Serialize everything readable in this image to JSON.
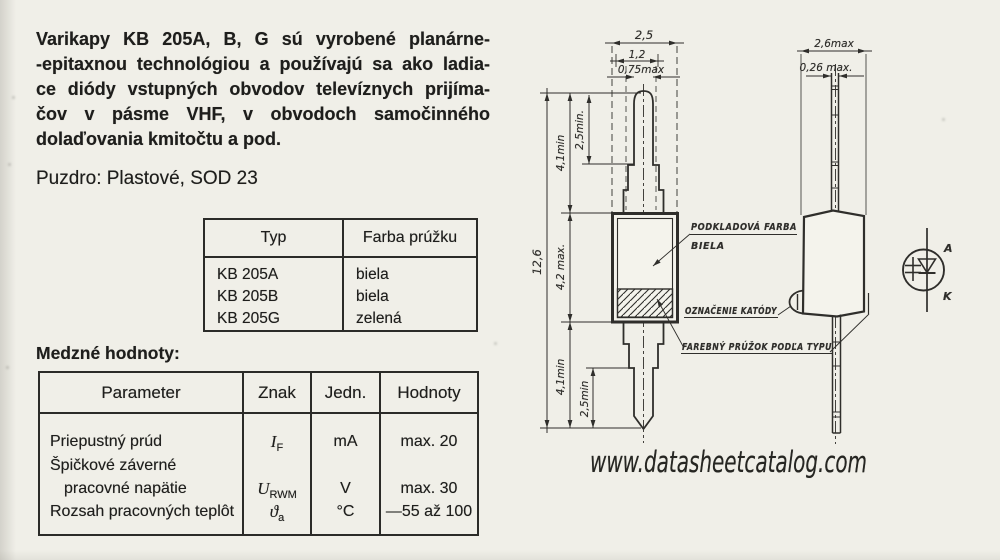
{
  "intro": {
    "lines": [
      "Varikapy KB 205A, B, G sú vyrobené planárne-",
      "-epitaxnou technológiou a používajú sa ako ladia-",
      "ce diódy vstupných obvodov televíznych prijíma-",
      "čov v pásme VHF, v obvodoch samočinného",
      "dolaďovania kmitočtu a pod."
    ]
  },
  "package_line": "Puzdro: Plastové, SOD 23",
  "type_table": {
    "header_typ": "Typ",
    "header_color": "Farba prúžku",
    "rows": [
      {
        "typ": "KB 205A",
        "farba": "biela"
      },
      {
        "typ": "KB 205B",
        "farba": "biela"
      },
      {
        "typ": "KB 205G",
        "farba": "zelená"
      }
    ]
  },
  "limits_heading": "Medzné hodnoty:",
  "limits_table": {
    "headers": {
      "parameter": "Parameter",
      "znak": "Znak",
      "jedn": "Jedn.",
      "hodnoty": "Hodnoty"
    },
    "row1": {
      "parameter": "Priepustný prúd",
      "symbol": "I",
      "sub": "F",
      "unit": "mA",
      "value": "max. 20"
    },
    "row2": {
      "parameter_line1": "Špičkové záverné",
      "parameter_line2": "pracovné napätie",
      "symbol": "U",
      "sub": "RWM",
      "unit": "V",
      "value": "max. 30"
    },
    "row3": {
      "parameter": "Rozsah pracovných teplôt",
      "symbol": "ϑ",
      "sub": "a",
      "unit": "°C",
      "value": "—55 až 100"
    }
  },
  "drawing": {
    "front": {
      "dim_25": "2,5",
      "dim_12": "1,2",
      "dim_075": "0,75max",
      "dim_126": "12,6",
      "dim_41_top": "4,1min",
      "dim_25min_top": "2,5min.",
      "dim_42": "4,2 max.",
      "dim_41_bot": "4,1min",
      "dim_25min_bot": "2,5min",
      "label_base_color_1": "PODKLADOVÁ FARBA",
      "label_base_color_2": "BIELA",
      "label_cathode_mark": "OZNAČENIE KATÓDY",
      "label_stripe": "FAREBNÝ PRÚŽOK PODĽA TYPU"
    },
    "side": {
      "dim_26": "2,6max",
      "dim_026": "0,26 max."
    },
    "symbol": {
      "anode": "A",
      "cathode": "K"
    }
  },
  "watermark": "www.datasheetcatalog.com"
}
